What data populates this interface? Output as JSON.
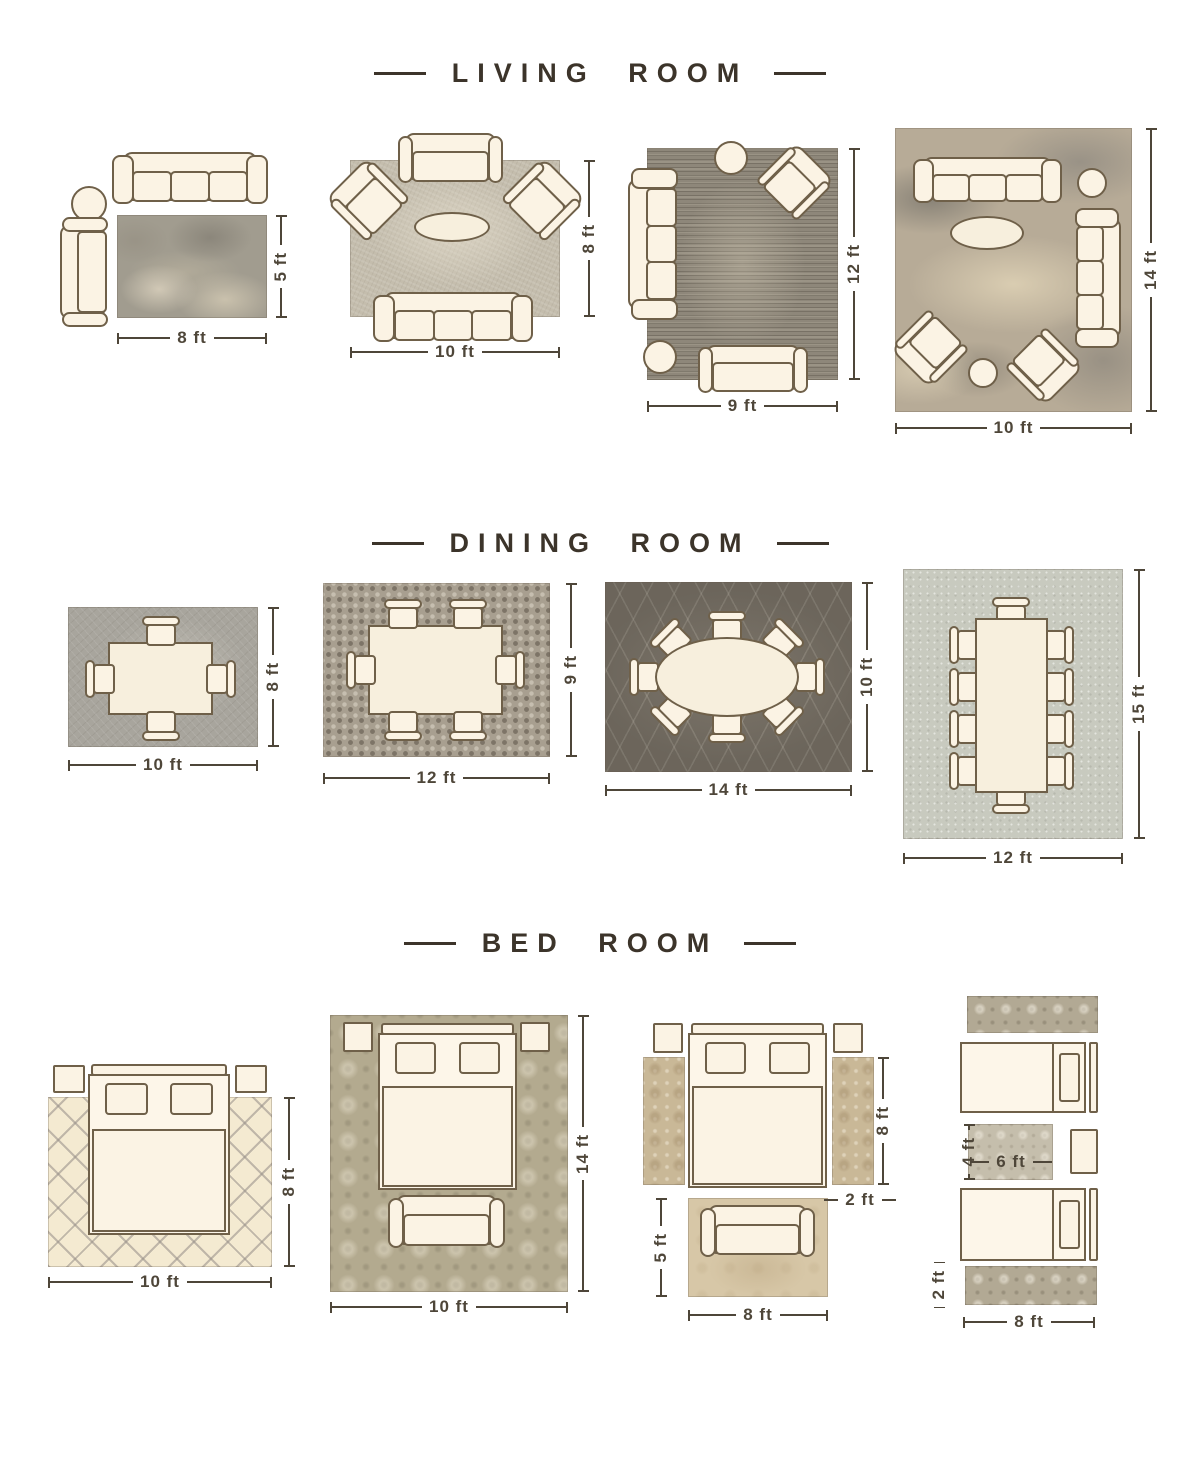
{
  "colors": {
    "ink": "#3c342a",
    "furniture_outline": "#6f6049",
    "furniture_fill": "#fbf3e4",
    "dimension": "#4e4639"
  },
  "sections": [
    {
      "title": "LIVING ROOM",
      "layouts": [
        {
          "name": "sofa-loveseat-off-rug",
          "rug_width": "8 ft",
          "rug_height": "5 ft"
        },
        {
          "name": "front-legs-on-rug",
          "rug_width": "10 ft",
          "rug_height": "8 ft"
        },
        {
          "name": "sofa-half-on-rug",
          "rug_width": "9 ft",
          "rug_height": "12 ft"
        },
        {
          "name": "all-furniture-on-rug",
          "rug_width": "10 ft",
          "rug_height": "14 ft"
        }
      ]
    },
    {
      "title": "DINING ROOM",
      "layouts": [
        {
          "name": "square-table-4-chairs",
          "rug_width": "10 ft",
          "rug_height": "8 ft"
        },
        {
          "name": "rectangle-table-6-chairs",
          "rug_width": "12 ft",
          "rug_height": "9 ft"
        },
        {
          "name": "oval-table-8-chairs",
          "rug_width": "14 ft",
          "rug_height": "10 ft"
        },
        {
          "name": "long-table-10-chairs",
          "rug_width": "12 ft",
          "rug_height": "15 ft"
        }
      ]
    },
    {
      "title": "BED ROOM",
      "layouts": [
        {
          "name": "bed-two-thirds-on-rug",
          "rug_width": "10 ft",
          "rug_height": "8 ft"
        },
        {
          "name": "bed-fully-on-rug",
          "rug_width": "10 ft",
          "rug_height": "14 ft"
        },
        {
          "name": "side-runners-and-foot-rug",
          "runner_height": "8 ft",
          "runner_width": "2 ft",
          "foot_rug_height": "5 ft",
          "foot_rug_width": "8 ft"
        },
        {
          "name": "twin-beds-runners",
          "middle_rug_height": "4 ft",
          "middle_rug_width": "6 ft",
          "runner_height": "2 ft",
          "runner_width": "8 ft"
        }
      ]
    }
  ]
}
